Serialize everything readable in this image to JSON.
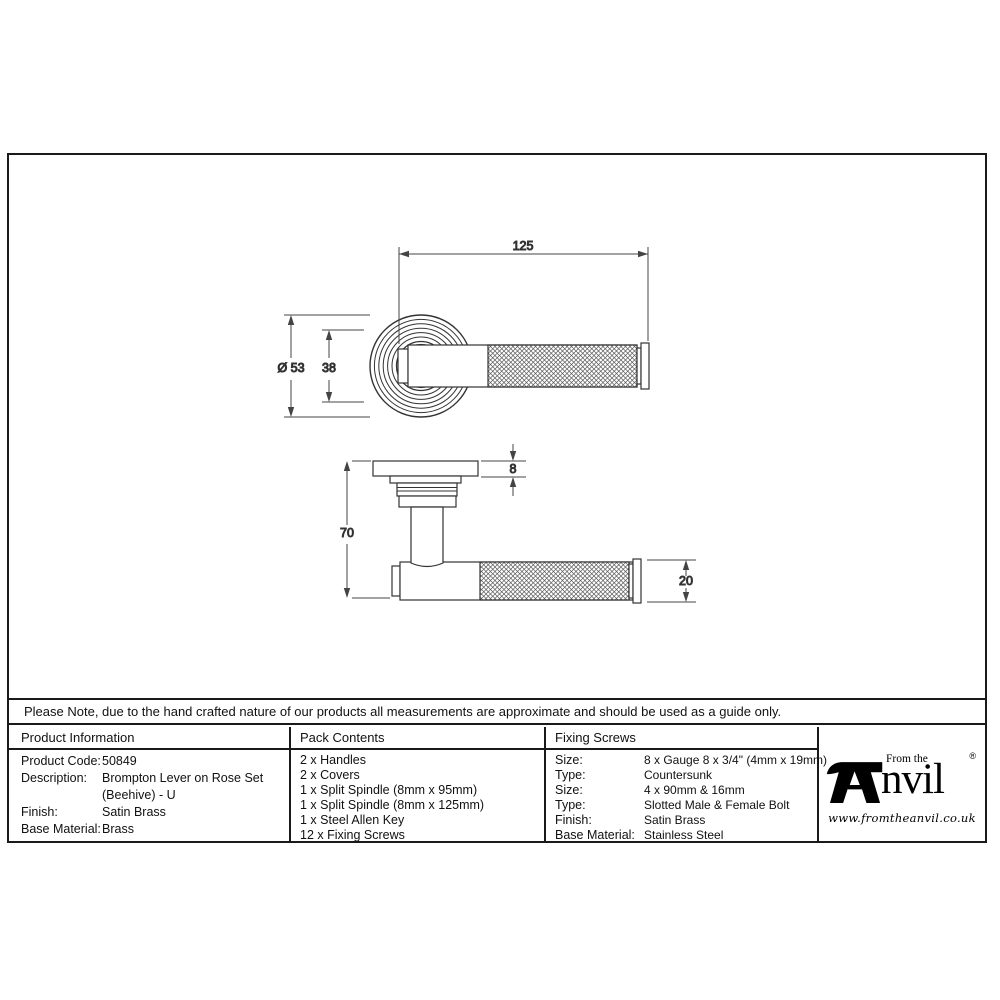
{
  "document": {
    "note": "Please Note, due to the hand crafted nature of our products all measurements are approximate and should be used as a guide only."
  },
  "drawing": {
    "front_view": {
      "width_dim": "125",
      "diameter_dim": "Ø 53",
      "center_dim": "38"
    },
    "side_view": {
      "rose_thickness_dim": "8",
      "projection_dim": "70",
      "lever_diameter_dim": "20"
    }
  },
  "table": {
    "product_information": {
      "header": "Product Information",
      "rows": [
        [
          "Product Code:",
          "50849"
        ],
        [
          "Description:",
          "Brompton Lever on Rose Set (Beehive) - U"
        ],
        [
          "Finish:",
          "Satin Brass"
        ],
        [
          "Base Material:",
          "Brass"
        ]
      ]
    },
    "pack_contents": {
      "header": "Pack Contents",
      "items": [
        "2 x Handles",
        "2 x Covers",
        "1 x Split Spindle (8mm x 95mm)",
        "1 x Split Spindle (8mm x 125mm)",
        "1 x Steel Allen Key",
        "12 x Fixing Screws"
      ]
    },
    "fixing_screws": {
      "header": "Fixing Screws",
      "rows": [
        [
          "Size:",
          "8 x Gauge 8 x 3/4\" (4mm x 19mm)"
        ],
        [
          "Type:",
          "Countersunk"
        ],
        [
          "Size:",
          "4 x 90mm & 16mm"
        ],
        [
          "Type:",
          "Slotted Male & Female Bolt"
        ],
        [
          "Finish:",
          "Satin Brass"
        ],
        [
          "Base Material:",
          "Stainless Steel"
        ]
      ]
    }
  },
  "logo": {
    "prefix": "From the",
    "wordmark": "nvil",
    "registered": "®",
    "website": "www.fromtheanvil.co.uk"
  },
  "colors": {
    "line": "#333333",
    "border": "#1a1a1a",
    "text": "#111111",
    "background": "#ffffff"
  }
}
